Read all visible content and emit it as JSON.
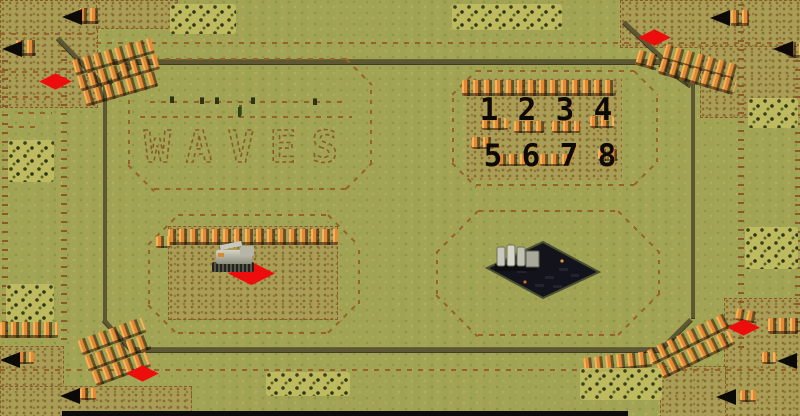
{
  "map": {
    "terrain_text": "WAVES",
    "wave_numbers": {
      "row1": [
        "1",
        "2",
        "3",
        "4"
      ],
      "row2": [
        "5",
        "6",
        "7",
        "8"
      ]
    }
  },
  "entities": {
    "spawn_marker_count": 5,
    "cave_entrance_count": 8,
    "unit": "mcv",
    "structure": "base-slab-with-silos"
  },
  "icons": {
    "spawn_marker": "red-diamond",
    "cave_entrance": "black-triangle",
    "cliff": "orange-ridge",
    "shrub": "dark-speckle-patch"
  },
  "colors": {
    "grass": "#a4a656",
    "sand": "#a89e55",
    "sand_dot": "#8a6a36",
    "path_dash": "#96622a",
    "road": "#5e5733",
    "cliff_orange": "#e28a33",
    "cave_black": "#0b0a07",
    "spawn_red": "#ee0d0d",
    "shrub_dark": "#39401a",
    "base_dark": "#13131b"
  }
}
